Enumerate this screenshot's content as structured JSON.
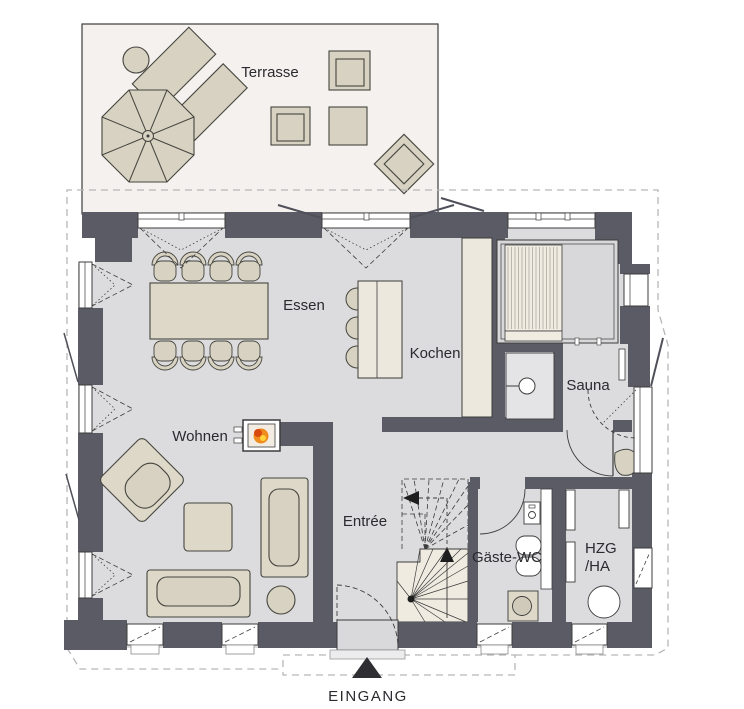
{
  "plan": {
    "rooms": {
      "terrace": "Terrasse",
      "dining": "Essen",
      "kitchen": "Kochen",
      "sauna": "Sauna",
      "living": "Wohnen",
      "entry": "Entrée",
      "guest_wc": "Gäste-WC",
      "utility_line1": "HZG",
      "utility_line2": "/HA"
    },
    "entrance_label": "EINGANG"
  },
  "icons": {
    "fireplace": "fire-icon",
    "stairs_up": "arrow-up-icon",
    "stairs_run": "arrow-left-icon",
    "entrance_marker": "triangle-up-icon"
  },
  "colors": {
    "wall": "#5b5b65",
    "floor": "#dcdcde",
    "terrace_bg": "#f5f1ee",
    "furniture_beige": "#d7d2c1",
    "cream": "#ece8dd",
    "stair_tread": "#f0ebe1",
    "outline": "#3c3c3c",
    "roof_dashed": "#b6b6b6",
    "flame_orange": "#f08c1e",
    "flame_red": "#d9480f",
    "flame_yellow": "#ffd43b",
    "label_text": "#2a2a2f"
  }
}
